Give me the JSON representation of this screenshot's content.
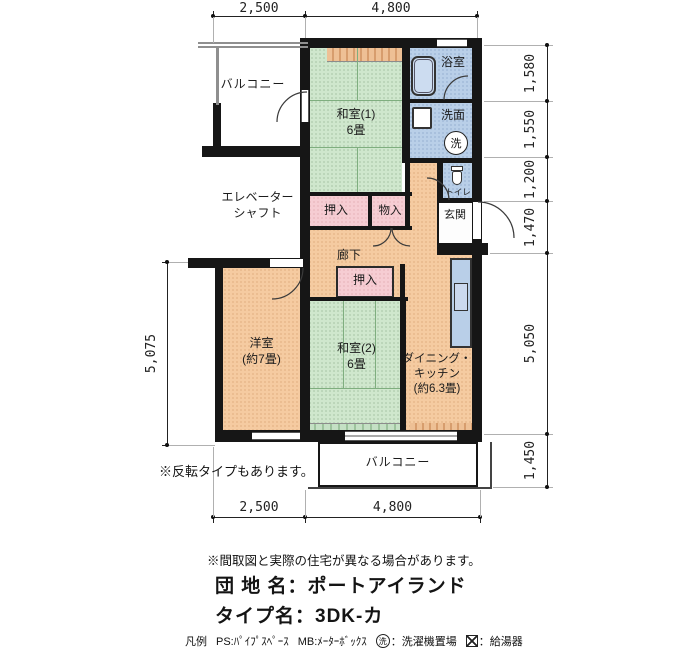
{
  "dims": {
    "top": [
      "2,500",
      "4,800"
    ],
    "bottom": [
      "2,500",
      "4,800"
    ],
    "right": [
      "1,580",
      "1,550",
      "1,200",
      "1,470",
      "5,050",
      "1,450"
    ],
    "left": [
      "5,075"
    ]
  },
  "rooms": {
    "balcony_top": "バルコニー",
    "balcony_bottom": "バルコニー",
    "washitsu1": "和室(1)\n6畳",
    "bath": "浴室",
    "washroom": "洗面",
    "laundry_mark": "洗",
    "toilet": "トイレ",
    "entrance": "玄関",
    "closet1": "押入",
    "closet2": "押入",
    "storage": "物入",
    "elevator": "エレベーター\nシャフト",
    "hallway": "廊下",
    "western_room": "洋室\n(約7畳)",
    "washitsu2": "和室(2)\n6畳",
    "dining_kitchen": "ダイニング・\nキッチン\n(約6.3畳)"
  },
  "notes": {
    "mirror": "※反転タイプもあります。",
    "disclaimer": "※間取図と実際の住宅が異なる場合があります。"
  },
  "info": {
    "estate_label": "団 地 名：ポートアイランド",
    "type_label": "タイプ名：3DK-カ"
  },
  "legend": {
    "title": "凡例",
    "ps": "PS:ﾊﾟｲﾌﾟｽﾍﾟｰｽ",
    "mb": "MB:ﾒｰﾀｰﾎﾞｯｸｽ",
    "laundry_mark": "洗",
    "laundry": "：洗濯機置場",
    "heater": "：給湯器"
  },
  "colors": {
    "tatami": "#cfe7cd",
    "wood": "#f5cba1",
    "wet": "#b9cfe8",
    "closet": "#f6cdd3",
    "wall": "#161616"
  }
}
